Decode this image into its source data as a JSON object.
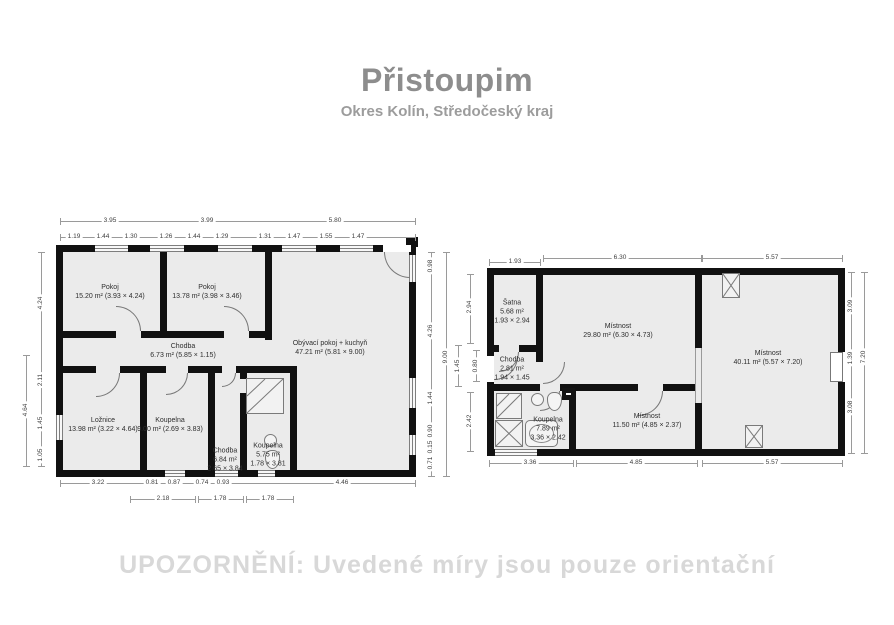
{
  "header": {
    "title": "Přistoupim",
    "subtitle": "Okres Kolín, Středočeský kraj"
  },
  "footer": {
    "warning": "UPOZORNĚNÍ: Uvedené míry jsou pouze orientační"
  },
  "colors": {
    "wall": "#111111",
    "floor": "#ebebeb",
    "title_gray": "#8d8d8d",
    "warning_gray": "#d8d8d8"
  },
  "plan_left": {
    "rooms": {
      "pokoj1": {
        "name": "Pokoj",
        "detail": "15.20 m² (3.93 × 4.24)"
      },
      "pokoj2": {
        "name": "Pokoj",
        "detail": "13.78 m² (3.98 × 3.46)"
      },
      "chodba": {
        "name": "Chodba",
        "detail": "6.73 m² (5.85 × 1.15)"
      },
      "obyvaci": {
        "name": "Obývací pokoj + kuchyň",
        "detail": "47.21 m² (5.81 × 9.00)"
      },
      "loznice": {
        "name": "Ložnice",
        "detail": "13.98 m² (3.22 × 4.64)"
      },
      "koupelna_velka": {
        "name": "Koupelna",
        "detail": "9.00 m² (2.69 × 3.83)"
      },
      "chodba_mala": {
        "name": "Chodba",
        "area": "6.84 m²",
        "size": "2.65 × 3.84"
      },
      "koupelna_mala": {
        "name": "Koupelna",
        "area": "5.75 m²",
        "size": "1.78 × 3.81"
      }
    },
    "dims": {
      "top1": [
        "3.95",
        "3.99",
        "5.80"
      ],
      "top2": [
        "1.19",
        "1.44",
        "1.30",
        "1.26",
        "1.44",
        "1.29",
        "1.31",
        "1.47",
        "1.55",
        "1.47"
      ],
      "bottom1": [
        "3.22",
        "0.81",
        "0.87",
        "0.74",
        "0.93",
        "4.46"
      ],
      "bottom2": [
        "2.18",
        "1.78",
        "1.78"
      ],
      "left": [
        "4.24",
        "2.11",
        "1.45",
        "1.05"
      ],
      "left_outer": "4.64",
      "right": [
        "0.98",
        "4.26",
        "1.44",
        "0.90",
        "0.15",
        "0.71"
      ],
      "right_outer": "9.00"
    }
  },
  "plan_right": {
    "rooms": {
      "satna": {
        "name": "Šatna",
        "area": "5.68 m²",
        "size": "1.93 × 2.94"
      },
      "chodba": {
        "name": "Chodba",
        "area": "2.81 m²",
        "size": "1.94 × 1.45"
      },
      "mistnost1": {
        "name": "Místnost",
        "detail": "29.80 m² (6.30 × 4.73)"
      },
      "mistnost2": {
        "name": "Místnost",
        "detail": "40.11 m² (5.57 × 7.20)"
      },
      "koupelna": {
        "name": "Koupelna",
        "area": "7.89 m²",
        "size": "3.36 × 2.42"
      },
      "mistnost3": {
        "name": "Místnost",
        "detail": "11.50 m² (4.85 × 2.37)"
      }
    },
    "dims": {
      "top": [
        "1.93",
        "6.30",
        "5.57"
      ],
      "bottom": [
        "3.36",
        "4.85",
        "5.57"
      ],
      "right": [
        "3.09",
        "1.39",
        "3.08"
      ],
      "right_outer": "7.20",
      "left": [
        "2.94",
        "1.45",
        "0.80",
        "2.42"
      ]
    }
  }
}
